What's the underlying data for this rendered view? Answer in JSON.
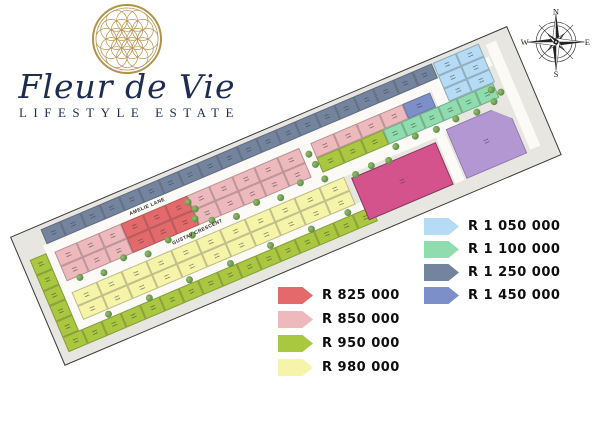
{
  "logo": {
    "title": "Fleur de Vie",
    "subtitle": "LIFESTYLE ESTATE"
  },
  "compass": {
    "north": "N",
    "east": "E",
    "south": "S",
    "west": "W"
  },
  "plan": {
    "streets": {
      "amelie": "AMELIE LANE",
      "gustav": "GUSTAV CRESCENT"
    }
  },
  "categories": {
    "red": "#e4696b",
    "pink": "#edb9bd",
    "green": "#a9c83f",
    "yellow": "#f6f4a9",
    "lightblue": "#b5dcf4",
    "mint": "#8fdcae",
    "slate": "#74849f",
    "periwinkle": "#7d8fc9",
    "magenta": "#d4538c",
    "purple": "#b297d3"
  },
  "legend": {
    "left": [
      {
        "key": "red",
        "price": "R 825 000"
      },
      {
        "key": "pink",
        "price": "R 850 000"
      },
      {
        "key": "green",
        "price": "R 950 000"
      },
      {
        "key": "yellow",
        "price": "R 980 000"
      }
    ],
    "right": [
      {
        "key": "lightblue",
        "price": "R 1 050 000"
      },
      {
        "key": "mint",
        "price": "R 1 100 000"
      },
      {
        "key": "slate",
        "price": "R 1 250 000"
      },
      {
        "key": "periwinkle",
        "price": "R 1 450 000"
      }
    ]
  },
  "style_colors": {
    "navy": "#1f2c52",
    "gold": "#b3924a",
    "road": "#fbfaf7",
    "plan_background": "#e8e6e1",
    "outline": "#3c3c3c",
    "tree": "#5b8743"
  }
}
